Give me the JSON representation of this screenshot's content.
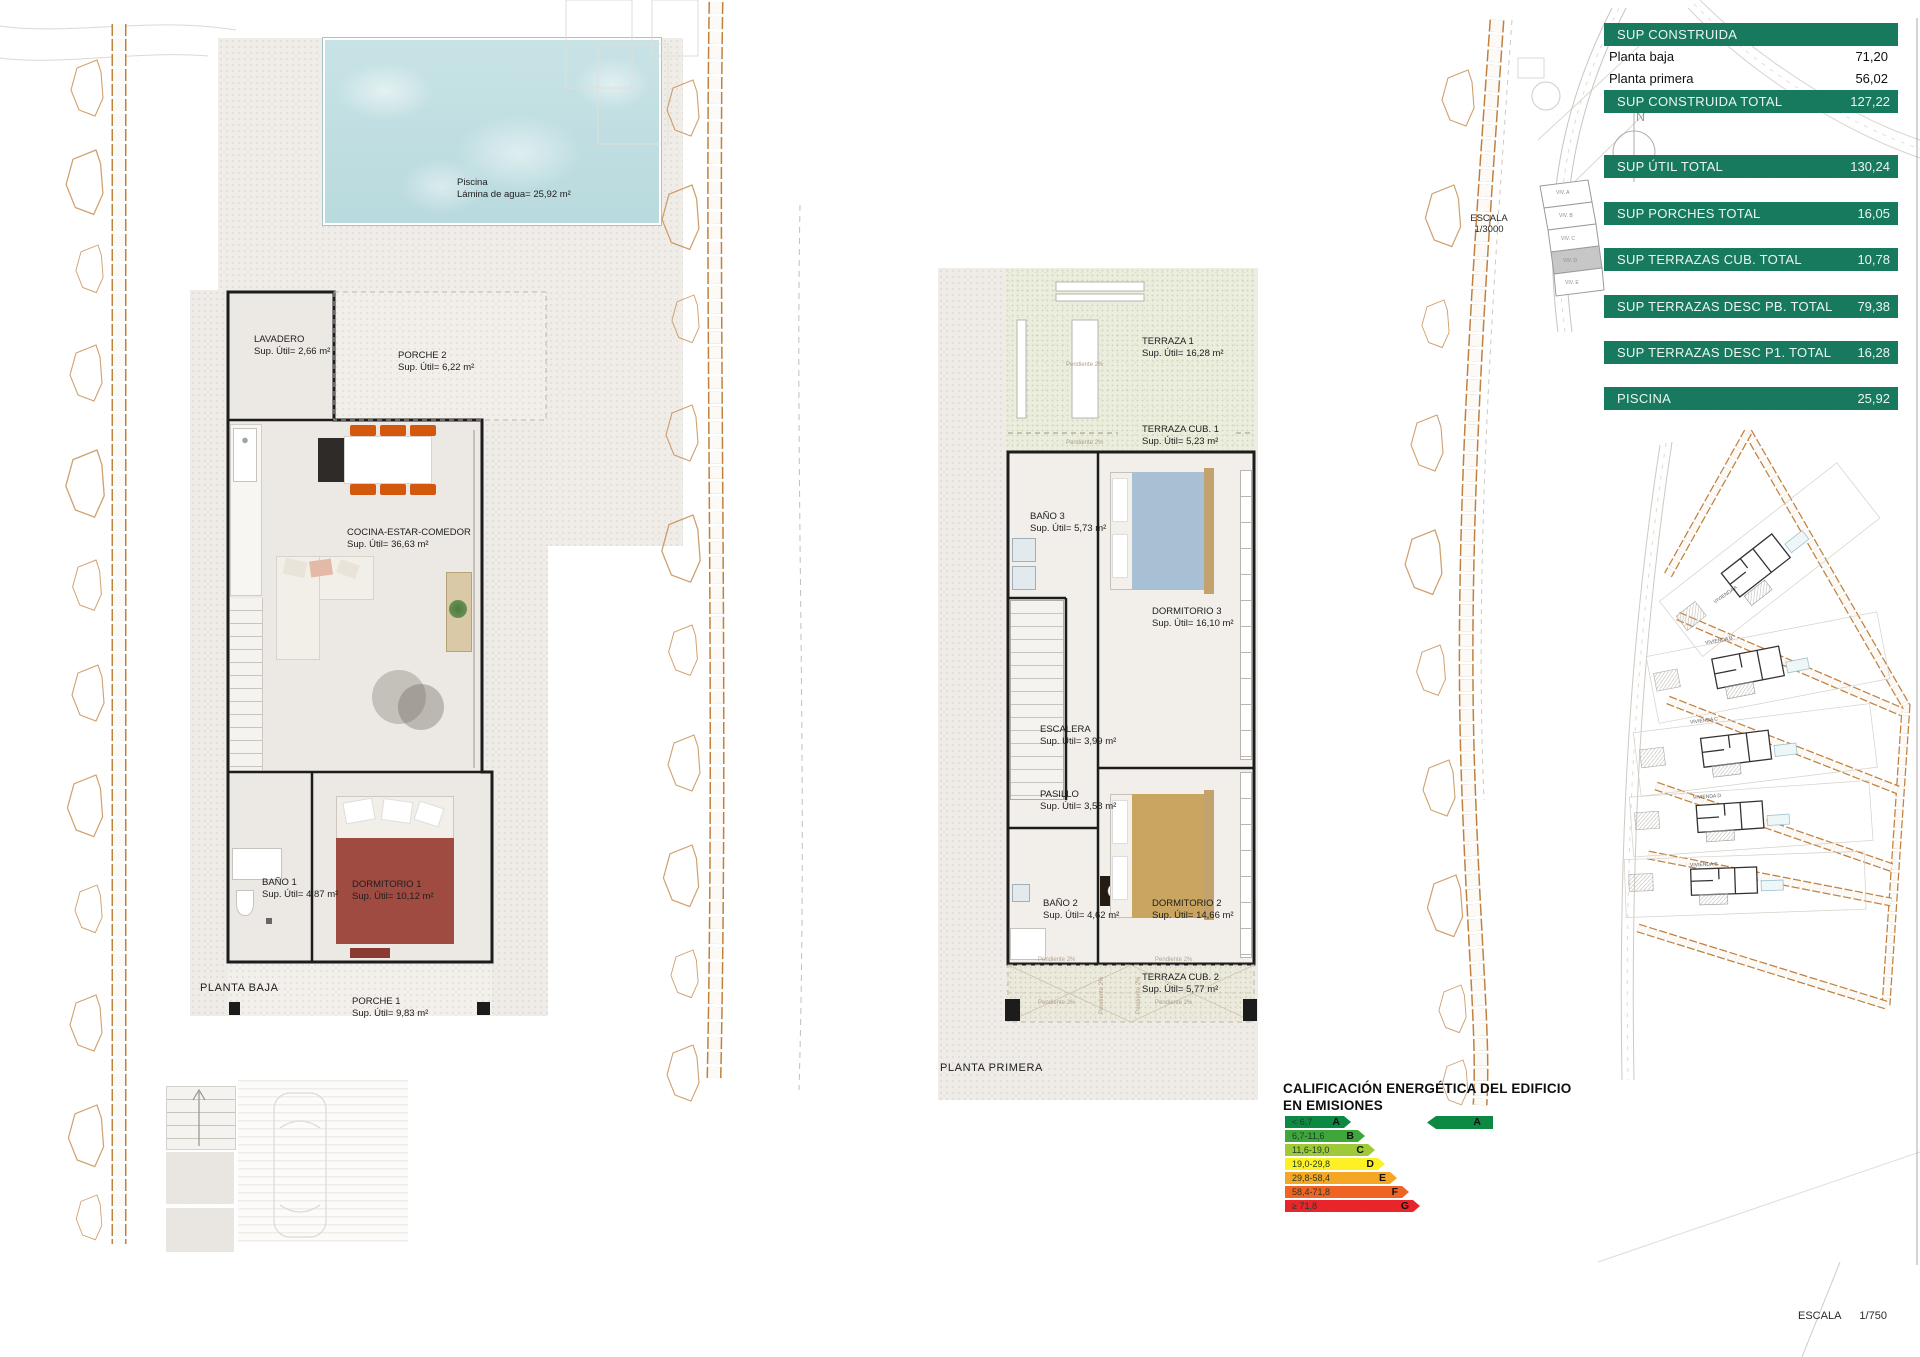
{
  "sheet": {
    "scale_site": {
      "label": "ESCALA",
      "value": "1/3000"
    },
    "scale_sheet": {
      "label": "ESCALA",
      "value": "1/750"
    },
    "compass_letter": "N"
  },
  "summary_table": {
    "accent_color": "#177a5f",
    "header": "SUP CONSTRUIDA",
    "sub_rows": [
      {
        "label": "Planta baja",
        "value": "71,20"
      },
      {
        "label": "Planta primera",
        "value": "56,02"
      }
    ],
    "bars": [
      {
        "label": "SUP CONSTRUIDA TOTAL",
        "value": "127,22"
      },
      {
        "label": "SUP ÚTIL TOTAL",
        "value": "130,24"
      },
      {
        "label": "SUP PORCHES TOTAL",
        "value": "16,05"
      },
      {
        "label": "SUP TERRAZAS CUB. TOTAL",
        "value": "10,78"
      },
      {
        "label": "SUP TERRAZAS DESC PB. TOTAL",
        "value": "79,38"
      },
      {
        "label": "SUP TERRAZAS DESC P1. TOTAL",
        "value": "16,28"
      },
      {
        "label": "PISCINA",
        "value": "25,92"
      }
    ]
  },
  "planta_baja": {
    "title": "PLANTA BAJA",
    "pool": {
      "name": "Piscina",
      "area": "Lámina de agua= 25,92 m²"
    },
    "rooms": [
      {
        "name": "LAVADERO",
        "area": "Sup. Útil= 2,66 m²"
      },
      {
        "name": "PORCHE 2",
        "area": "Sup. Útil= 6,22 m²"
      },
      {
        "name": "COCINA-ESTAR-COMEDOR",
        "area": "Sup. Útil= 36,63 m²"
      },
      {
        "name": "BAÑO 1",
        "area": "Sup. Útil= 4,87 m²"
      },
      {
        "name": "DORMITORIO 1",
        "area": "Sup. Útil= 10,12 m²"
      },
      {
        "name": "PORCHE 1",
        "area": "Sup. Útil= 9,83 m²"
      }
    ]
  },
  "planta_primera": {
    "title": "PLANTA PRIMERA",
    "pendiente_note": "Pendiente 2%",
    "rooms": [
      {
        "name": "TERRAZA 1",
        "area": "Sup. Útil= 16,28 m²"
      },
      {
        "name": "TERRAZA CUB. 1",
        "area": "Sup. Útil= 5,23 m²"
      },
      {
        "name": "BAÑO 3",
        "area": "Sup. Útil= 5,73 m²"
      },
      {
        "name": "DORMITORIO 3",
        "area": "Sup. Útil= 16,10 m²"
      },
      {
        "name": "ESCALERA",
        "area": "Sup. Útil= 3,99 m²"
      },
      {
        "name": "PASILLO",
        "area": "Sup. Útil= 3,58 m²"
      },
      {
        "name": "BAÑO 2",
        "area": "Sup. Útil= 4,62 m²"
      },
      {
        "name": "DORMITORIO 2",
        "area": "Sup. Útil= 14,66 m²"
      },
      {
        "name": "TERRAZA CUB. 2",
        "area": "Sup. Útil= 5,77 m²"
      }
    ]
  },
  "key_plan": {
    "plots": [
      "VIV. A",
      "VIV. B",
      "VIV. C",
      "VIV. D",
      "VIV. E"
    ]
  },
  "site_plan": {
    "plots": [
      "VIVIENDA A",
      "VIVIENDA B",
      "VIVIENDA C",
      "VIVIENDA D",
      "VIVIENDA E"
    ]
  },
  "energy_rating": {
    "title_line1": "CALIFICACIÓN ENERGÉTICA DEL EDIFICIO",
    "title_line2": "EN EMISIONES",
    "bands": [
      {
        "range": "< 6,7",
        "letter": "A",
        "color": "#0c8a44"
      },
      {
        "range": "6,7-11,6",
        "letter": "B",
        "color": "#3fa63b"
      },
      {
        "range": "11,6-19,0",
        "letter": "C",
        "color": "#a0c93a"
      },
      {
        "range": "19,0-29,8",
        "letter": "D",
        "color": "#fdf126"
      },
      {
        "range": "29,8-58,4",
        "letter": "E",
        "color": "#f5a623"
      },
      {
        "range": "58,4-71,8",
        "letter": "F",
        "color": "#ef6425"
      },
      {
        "range": "≥ 71,8",
        "letter": "G",
        "color": "#e9252c"
      }
    ],
    "rating_letter": "A",
    "rating_color": "#0c8a44"
  }
}
